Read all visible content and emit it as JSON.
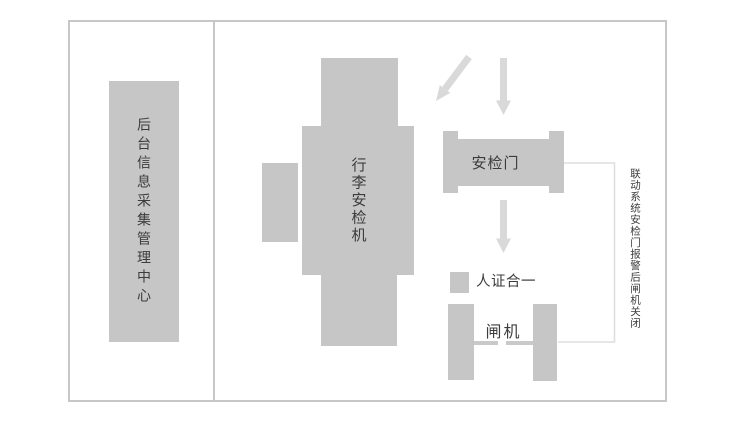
{
  "diagram": {
    "left_panel": {
      "label": "后台信息采集管理中心"
    },
    "baggage_machine": {
      "label": "行李安检机"
    },
    "security_gate": {
      "label": "安检门"
    },
    "id_verification": {
      "label": "人证合一"
    },
    "turnstile": {
      "label": "闸机"
    },
    "linkage_note": {
      "label": "联动系统安检门报警后闸机关闭"
    },
    "icons": {
      "entry_arrow_diagonal": "arrow-down-left-icon",
      "entry_arrow_vertical": "arrow-down-icon",
      "flow_arrow_to_id_check": "arrow-down-icon"
    },
    "colors": {
      "background": "#ffffff",
      "box_fill": "#c6c6c6",
      "frame_border": "#c7c7c7",
      "arrow_fill": "#d9d9d9",
      "connector_line": "#dedede",
      "text": "#3c3c3c"
    }
  }
}
